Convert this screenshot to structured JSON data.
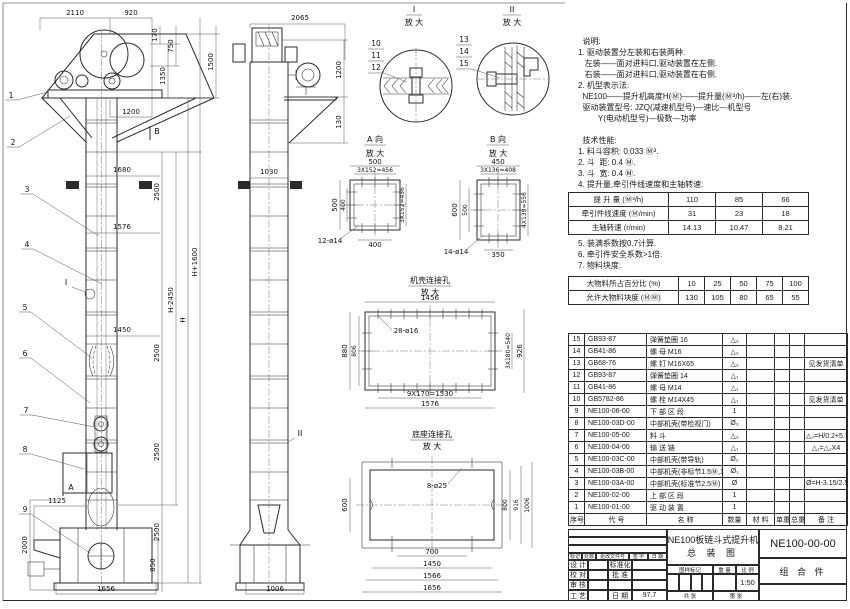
{
  "notes": {
    "lines": [
      "  说明:",
      "1. 驱动装置分左装和右装两种.",
      "   左装——面对进料口,驱动装置在左侧.",
      "   右装——面对进料口,驱动装置在右侧.",
      "2. 机型表示法:",
      "  NE100——提升机高度H(Ⓜ)——提升量(Ⓜ³/h)——左(右)装.",
      "  驱动装置型号: JZQ(减速机型号)—速比—机型号",
      "         Y(电动机型号)—极数—功率",
      "",
      "  技术性能:",
      "1. 料斗容积: 0.033 Ⓜ³.",
      "2. 斗  距: 0.4 Ⓜ.",
      "3. 斗  宽: 0.4 Ⓜ.",
      "4. 提升量,牵引件线速度和主轴转速:"
    ],
    "lines2": [
      "5. 装满系数按0.7计算.",
      "6. 牵引件安全系数>1倍.",
      "7. 物料块度:"
    ]
  },
  "perf_table": {
    "rows": [
      [
        "提 升 量  (Ⓜ³/h)",
        "110",
        "85",
        "66"
      ],
      [
        "牵引件线速度 (Ⓜ/min)",
        "31",
        "23",
        "18"
      ],
      [
        "主轴转速 (r/min)",
        "14.13",
        "10.47",
        "8.21"
      ]
    ]
  },
  "lump_table": {
    "rows": [
      [
        "大物料所占百分比 (%)",
        "10",
        "25",
        "50",
        "75",
        "100"
      ],
      [
        "允许大物料块度 (ⓂⓂ)",
        "130",
        "105",
        "80",
        "65",
        "55"
      ]
    ]
  },
  "bom": {
    "rows": [
      [
        "15",
        "GB93-87",
        "弹簧垫圈 16",
        "△₂",
        "",
        "",
        "",
        ""
      ],
      [
        "14",
        "GB41-86",
        "螺 母  M16",
        "△₂",
        "",
        "",
        "",
        ""
      ],
      [
        "13",
        "GB68-76",
        "螺 钉  M16X65",
        "△₂",
        "",
        "",
        "",
        "见发货清单"
      ],
      [
        "12",
        "GB93-87",
        "弹簧垫圈 14",
        "△₁",
        "",
        "",
        "",
        ""
      ],
      [
        "11",
        "GB41-86",
        "螺 母  M14",
        "△₁",
        "",
        "",
        "",
        ""
      ],
      [
        "10",
        "GB5782-86",
        "螺 栓  M14X45",
        "△₁",
        "",
        "",
        "",
        "见发货清单"
      ],
      [
        "9",
        "NE100-06-00",
        "下 部 区 段",
        "1",
        "",
        "",
        "",
        ""
      ],
      [
        "8",
        "NE100-03D-00",
        "中部机壳(带检视门)",
        "Ø₃",
        "",
        "",
        "",
        ""
      ],
      [
        "7",
        "NE100-05-00",
        "料  斗",
        "△₂",
        "",
        "",
        "",
        "△₂=H/0.2+5.75"
      ],
      [
        "6",
        "NE100-04-00",
        "输 送 链",
        "△₁",
        "",
        "",
        "",
        "△₁=△₂X4"
      ],
      [
        "5",
        "NE100-03C-00",
        "中部机壳(带导轨)",
        "Ø₂",
        "",
        "",
        "",
        ""
      ],
      [
        "4",
        "NE100-03B-00",
        "中部机壳(非标节1.5Ⓜ,1Ⓜ)",
        "Ø₁",
        "",
        "",
        "",
        ""
      ],
      [
        "3",
        "NE100-03A-00",
        "中部机壳(标准节2.5Ⓜ)",
        "Ø",
        "",
        "",
        "",
        "Ø=H-3.15/2.5"
      ],
      [
        "2",
        "NE100-02-00",
        "上 部 区 段",
        "1",
        "",
        "",
        "",
        ""
      ],
      [
        "1",
        "NE100-01-00",
        "驱 动 装 置",
        "1",
        "",
        "",
        "",
        ""
      ],
      [
        "序号",
        "代  号",
        "名    称",
        "数量",
        "材  料",
        "单重",
        "总重",
        "备  注"
      ]
    ]
  },
  "title_block": {
    "title_line1": "NE100板链斗式提升机",
    "title_line2": "总  装  图",
    "drawing_no": "NE100-00-00",
    "part_class": "组 合 件",
    "rev": {
      "mark": "标记",
      "count": "处数",
      "doc": "更改文件号",
      "sign": "签 字",
      "date": "日 期"
    },
    "roles": {
      "design": "设 计",
      "check": "校 对",
      "review": "审 核",
      "process": "工 艺",
      "standard": "标准化",
      "approve": "批 准",
      "date_label": "日 期",
      "date_value": "97.7"
    },
    "mark_header": {
      "sample": "图样标记",
      "weight": "重 量",
      "scale_label": "比 例"
    },
    "scale_value": "1:50",
    "sheet_total": "共  张",
    "sheet_no": "第  张"
  },
  "dw": {
    "fd": "放 大",
    "marks": {
      "a": "A",
      "b": "B",
      "i": "I",
      "ii": "II"
    },
    "balloons": {
      "n1": "1",
      "n2": "2",
      "n3": "3",
      "n4": "4",
      "n5": "5",
      "n6": "6",
      "n7": "7",
      "n8": "8",
      "n9": "9",
      "n10": "10",
      "n11": "11",
      "n12": "12",
      "n13": "13",
      "n14": "14",
      "n15": "15"
    },
    "fv": {
      "t2110": "2110",
      "t920": "920",
      "v170": "170",
      "v750": "750",
      "v1350": "1350",
      "v1500": "1500",
      "h1200": "1200",
      "w1680": "1680",
      "w1576": "1576",
      "w1450": "1450",
      "s2500": "2500",
      "hminus": "H-2450",
      "h": "H",
      "hplus": "H+1600",
      "d1125": "1125",
      "v2000": "2000",
      "v850": "850",
      "b1656": "1656"
    },
    "sv": {
      "t2065": "2065",
      "v1200": "1200",
      "v130": "130",
      "w1030": "1030",
      "b1006": "1006"
    },
    "details": {
      "i": "I",
      "ii": "II",
      "a": "A 向",
      "b": "B 向",
      "c": "机壳连接孔",
      "d": "底座连接孔"
    },
    "da": {
      "t500": "500",
      "t456": "3X152=456",
      "l500": "500",
      "l400": "400",
      "r456": "3X152=456",
      "b400": "400",
      "holes": "12-ø14"
    },
    "db": {
      "t450": "450",
      "t408": "3X136=408",
      "l600": "600",
      "l500": "500",
      "r556": "4X139=556",
      "b350": "350",
      "holes": "14-ø14"
    },
    "dc": {
      "t1456": "1456",
      "holes": "28-ø16",
      "l880": "880",
      "l806": "806",
      "r540": "3X180=540",
      "r926": "926",
      "b1530": "9X170=1530",
      "b1576": "1576"
    },
    "dd": {
      "holes": "8-ø25",
      "l600": "600",
      "r800": "800",
      "r916": "916",
      "r1006": "1006",
      "b700": "700",
      "b1450": "1450",
      "b1566": "1566",
      "b1656": "1656"
    }
  }
}
